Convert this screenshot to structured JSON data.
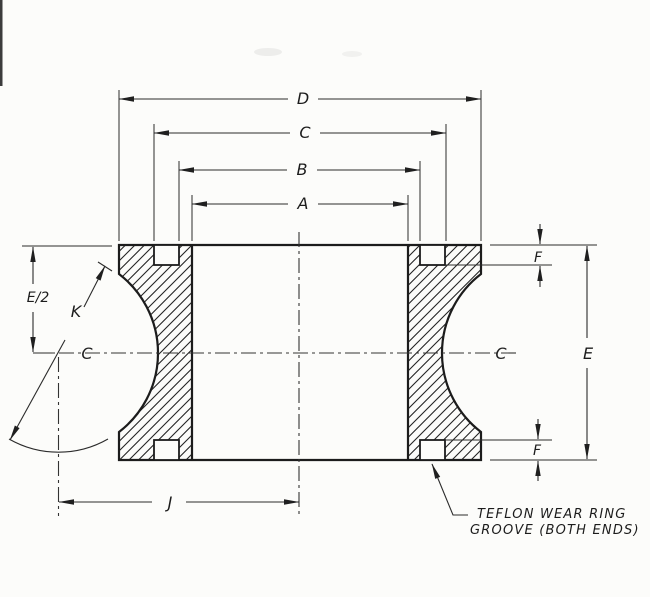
{
  "drawing": {
    "type": "engineering-cross-section",
    "subject": "sheave / pulley rim cross-section with cable groove and teflon wear ring grooves",
    "colors": {
      "ink": "#1c1c1c",
      "background": "#fcfcfa"
    },
    "dimensions": {
      "d": "D",
      "c": "C",
      "b": "B",
      "a": "A",
      "e_half": "E/2",
      "k": "K",
      "e": "E",
      "f_top": "F",
      "f_bottom": "F",
      "j": "J"
    },
    "centerline_symbol": "C",
    "note": {
      "line1": "TEFLON WEAR RING",
      "line2": "GROOVE (BOTH ENDS)"
    }
  }
}
